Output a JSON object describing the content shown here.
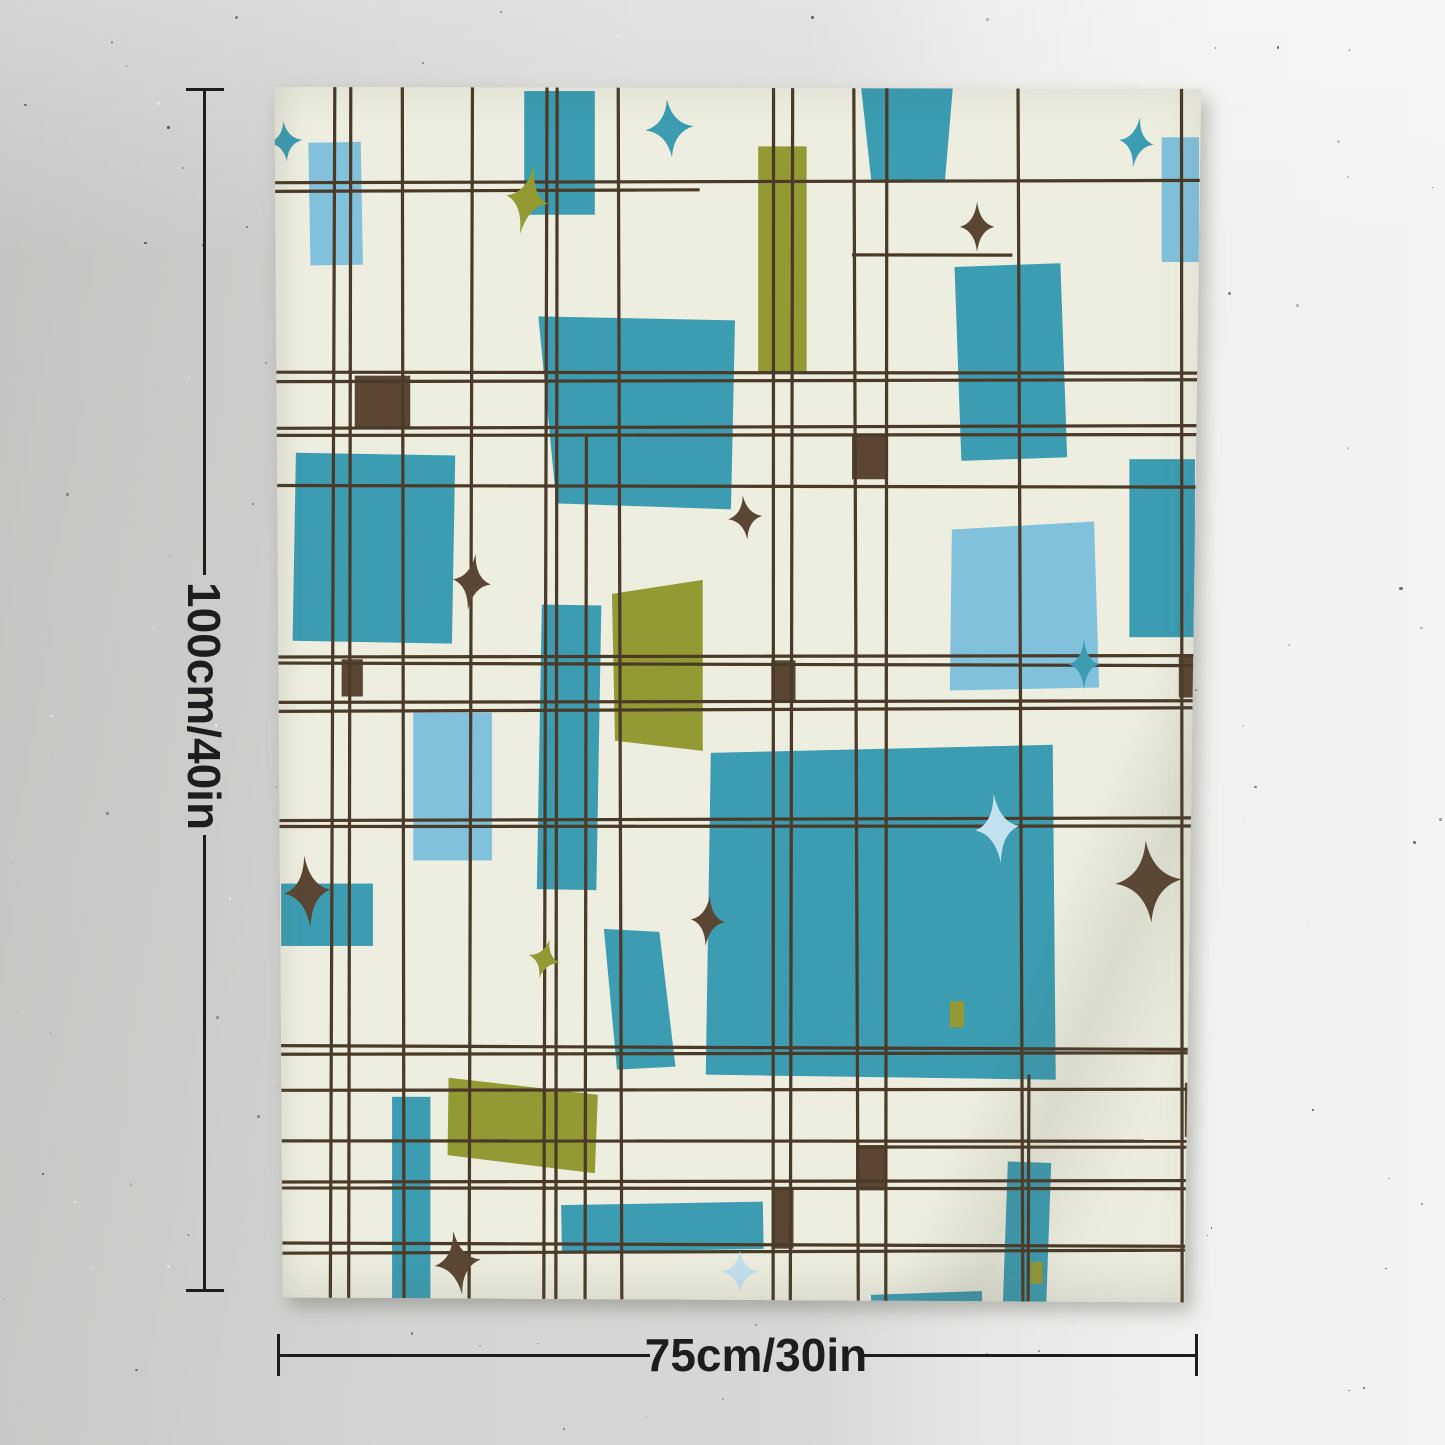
{
  "annotations": {
    "height_label": "100cm/40in",
    "width_label": "75cm/30in"
  },
  "colors": {
    "cream": "#edeee0",
    "teal": "#3b9cb2",
    "sky": "#82c1dc",
    "pale": "#c3e1ee",
    "olive": "#949a33",
    "brown": "#5a4632",
    "line": "#4a3a27",
    "annotation": "#1d1d1d"
  },
  "tapestry": {
    "view_w": 928,
    "view_h": 1215,
    "grid": {
      "width": 3.2,
      "v": [
        {
          "x": 66
        },
        {
          "x": 83
        },
        {
          "x": 136
        },
        {
          "x": 203
        },
        {
          "x": 277
        },
        {
          "x": 288
        },
        {
          "x": 317,
          "y1": 350
        },
        {
          "x": 351
        },
        {
          "x": 503
        },
        {
          "x": 521
        },
        {
          "x": 585
        },
        {
          "x": 615
        },
        {
          "x": 748
        },
        {
          "x": 756,
          "y1": 985
        },
        {
          "x": 908
        }
      ],
      "h": [
        {
          "y": 97
        },
        {
          "y": 106,
          "x2": 430
        },
        {
          "y": 170,
          "x1": 581,
          "x2": 740
        },
        {
          "y": 287
        },
        {
          "y": 295
        },
        {
          "y": 341
        },
        {
          "y": 349
        },
        {
          "y": 400
        },
        {
          "y": 569
        },
        {
          "y": 577
        },
        {
          "y": 614
        },
        {
          "y": 622
        },
        {
          "y": 731
        },
        {
          "y": 738
        },
        {
          "y": 958
        },
        {
          "y": 964
        },
        {
          "y": 1000
        },
        {
          "y": 1051
        },
        {
          "y": 1057,
          "x1": 585
        },
        {
          "y": 1091
        },
        {
          "y": 1098
        },
        {
          "y": 1154
        },
        {
          "y": 1161
        }
      ]
    },
    "polys": [
      {
        "pts": [
          [
            590,
            3
          ],
          [
            681,
            3
          ],
          [
            673,
            98
          ],
          [
            600,
            95
          ]
        ],
        "f": "teal"
      },
      {
        "pts": [
          [
            270,
            231
          ],
          [
            465,
            235
          ],
          [
            461,
            423
          ],
          [
            288,
            417
          ]
        ],
        "f": "teal"
      },
      {
        "pts": [
          [
            441,
            665
          ],
          [
            780,
            657
          ],
          [
            783,
            990
          ],
          [
            436,
            985
          ]
        ],
        "f": "teal"
      },
      {
        "pts": [
          [
            335,
            840
          ],
          [
            390,
            843
          ],
          [
            406,
            977
          ],
          [
            348,
            980
          ]
        ],
        "f": "teal"
      },
      {
        "pts": [
          [
            680,
            443
          ],
          [
            821,
            435
          ],
          [
            826,
            600
          ],
          [
            678,
            603
          ]
        ],
        "f": "sky"
      },
      {
        "pts": [
          [
            343,
            507
          ],
          [
            433,
            493
          ],
          [
            433,
            663
          ],
          [
            346,
            653
          ]
        ],
        "f": "olive"
      },
      {
        "pts": [
          [
            181,
            988
          ],
          [
            329,
            1005
          ],
          [
            326,
            1083
          ],
          [
            180,
            1065
          ]
        ],
        "f": "olive"
      }
    ],
    "rects": [
      {
        "x": 256,
        "y": 7,
        "w": 70,
        "h": 123,
        "f": "teal",
        "r": 0
      },
      {
        "x": 686,
        "y": 180,
        "w": 105,
        "h": 193,
        "f": "teal",
        "r": -2
      },
      {
        "x": 28,
        "y": 368,
        "w": 158,
        "h": 187,
        "f": "teal",
        "r": 1
      },
      {
        "x": 271,
        "y": 518,
        "w": 59,
        "h": 283,
        "f": "teal",
        "r": 1
      },
      {
        "x": 856,
        "y": 373,
        "w": 65,
        "h": 177,
        "f": "teal",
        "r": 0
      },
      {
        "x": 15,
        "y": 795,
        "w": 91,
        "h": 62,
        "f": "teal",
        "r": 0
      },
      {
        "x": 125,
        "y": 1007,
        "w": 38,
        "h": 206,
        "f": "teal",
        "r": 0
      },
      {
        "x": 293,
        "y": 1113,
        "w": 200,
        "h": 47,
        "f": "teal",
        "r": -1
      },
      {
        "x": 600,
        "y": 1202,
        "w": 110,
        "h": 13,
        "f": "teal",
        "r": -2
      },
      {
        "x": 733,
        "y": 1072,
        "w": 43,
        "h": 143,
        "f": "teal",
        "r": 2
      },
      {
        "x": 43,
        "y": 58,
        "w": 52,
        "h": 122,
        "f": "sky",
        "r": -1
      },
      {
        "x": 888,
        "y": 53,
        "w": 37,
        "h": 124,
        "f": "sky",
        "r": 0
      },
      {
        "x": 146,
        "y": 625,
        "w": 78,
        "h": 147,
        "f": "sky",
        "r": 0
      },
      {
        "x": 488,
        "y": 62,
        "w": 48,
        "h": 225,
        "f": "olive",
        "r": 0
      },
      {
        "x": 678,
        "y": 912,
        "w": 14,
        "h": 26,
        "f": "olive",
        "r": 0
      },
      {
        "x": 758,
        "y": 1171,
        "w": 12,
        "h": 22,
        "f": "olive",
        "r": 0
      }
    ],
    "brown_squares": [
      {
        "x": 88,
        "y": 290,
        "w": 55,
        "h": 53
      },
      {
        "x": 75,
        "y": 572,
        "w": 21,
        "h": 37
      },
      {
        "x": 501,
        "y": 573,
        "w": 24,
        "h": 42
      },
      {
        "x": 581,
        "y": 350,
        "w": 34,
        "h": 43
      },
      {
        "x": 905,
        "y": 567,
        "w": 18,
        "h": 43
      },
      {
        "x": 585,
        "y": 1055,
        "w": 31,
        "h": 45
      },
      {
        "x": 503,
        "y": 1098,
        "w": 20,
        "h": 60
      },
      {
        "x": 911,
        "y": 993,
        "w": 17,
        "h": 54
      }
    ],
    "stars": [
      {
        "cx": 19,
        "cy": 57,
        "rx": 17,
        "ry": 20,
        "rot": -5,
        "f": "teal"
      },
      {
        "cx": 259,
        "cy": 115,
        "rx": 21,
        "ry": 35,
        "rot": 12,
        "f": "olive"
      },
      {
        "cx": 400,
        "cy": 44,
        "rx": 24,
        "ry": 29,
        "rot": -5,
        "f": "teal"
      },
      {
        "cx": 863,
        "cy": 58,
        "rx": 17,
        "ry": 25,
        "rot": 8,
        "f": "teal"
      },
      {
        "cx": 705,
        "cy": 142,
        "rx": 17,
        "ry": 25,
        "rot": 0,
        "f": "brown"
      },
      {
        "cx": 204,
        "cy": 495,
        "rx": 19,
        "ry": 28,
        "rot": 8,
        "f": "brown"
      },
      {
        "cx": 475,
        "cy": 431,
        "rx": 17,
        "ry": 22,
        "rot": -6,
        "f": "brown"
      },
      {
        "cx": 811,
        "cy": 577,
        "rx": 15,
        "ry": 25,
        "rot": 0,
        "f": "teal"
      },
      {
        "cx": 41,
        "cy": 803,
        "rx": 23,
        "ry": 36,
        "rot": -5,
        "f": "brown"
      },
      {
        "cx": 875,
        "cy": 793,
        "rx": 33,
        "ry": 41,
        "rot": -4,
        "f": "brown"
      },
      {
        "cx": 725,
        "cy": 740,
        "rx": 22,
        "ry": 35,
        "rot": -6,
        "f": "pale"
      },
      {
        "cx": 276,
        "cy": 870,
        "rx": 16,
        "ry": 20,
        "rot": 15,
        "f": "olive"
      },
      {
        "cx": 190,
        "cy": 1172,
        "rx": 23,
        "ry": 32,
        "rot": -8,
        "f": "brown"
      },
      {
        "cx": 470,
        "cy": 1181,
        "rx": 19,
        "ry": 21,
        "rot": 0,
        "f": "pale"
      },
      {
        "cx": 438,
        "cy": 832,
        "rx": 17,
        "ry": 25,
        "rot": 5,
        "f": "brown"
      }
    ]
  }
}
